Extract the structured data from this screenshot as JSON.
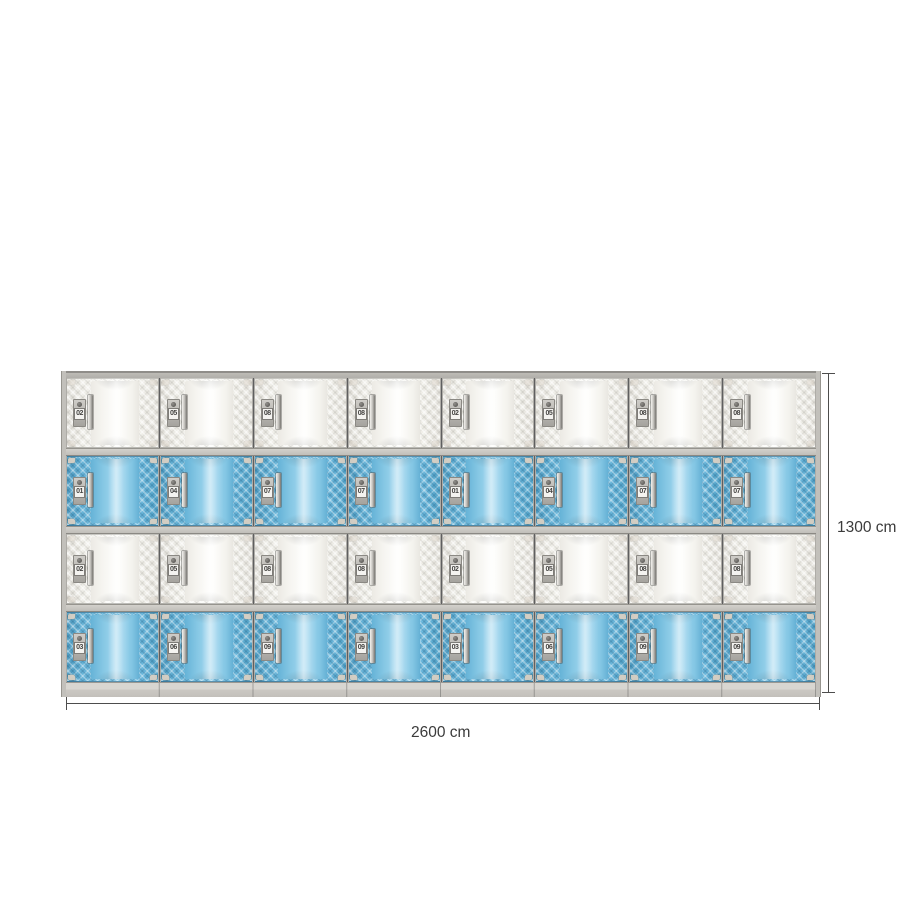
{
  "locker_bank": {
    "columns": 8,
    "tiers": 4,
    "rows": [
      {
        "door_color_name": "white",
        "numbers": [
          "02",
          "05",
          "08",
          "08",
          "02",
          "05",
          "08",
          "08"
        ]
      },
      {
        "door_color_name": "blue",
        "numbers": [
          "01",
          "04",
          "07",
          "07",
          "01",
          "04",
          "07",
          "07"
        ]
      },
      {
        "door_color_name": "white",
        "numbers": [
          "02",
          "05",
          "08",
          "08",
          "02",
          "05",
          "08",
          "08"
        ]
      },
      {
        "door_color_name": "blue",
        "numbers": [
          "03",
          "06",
          "09",
          "09",
          "03",
          "06",
          "09",
          "09"
        ]
      }
    ],
    "colors": {
      "blue_door": "#74bedd",
      "white_door": "#f3f2ee",
      "frame_grey": "#c2c0bb",
      "base_grey": "#d5d3ce"
    }
  },
  "dimension_annotations": {
    "height": {
      "label": "1300 cm"
    },
    "width": {
      "label": "2600 cm"
    },
    "line_color": "#4d4d4d"
  }
}
